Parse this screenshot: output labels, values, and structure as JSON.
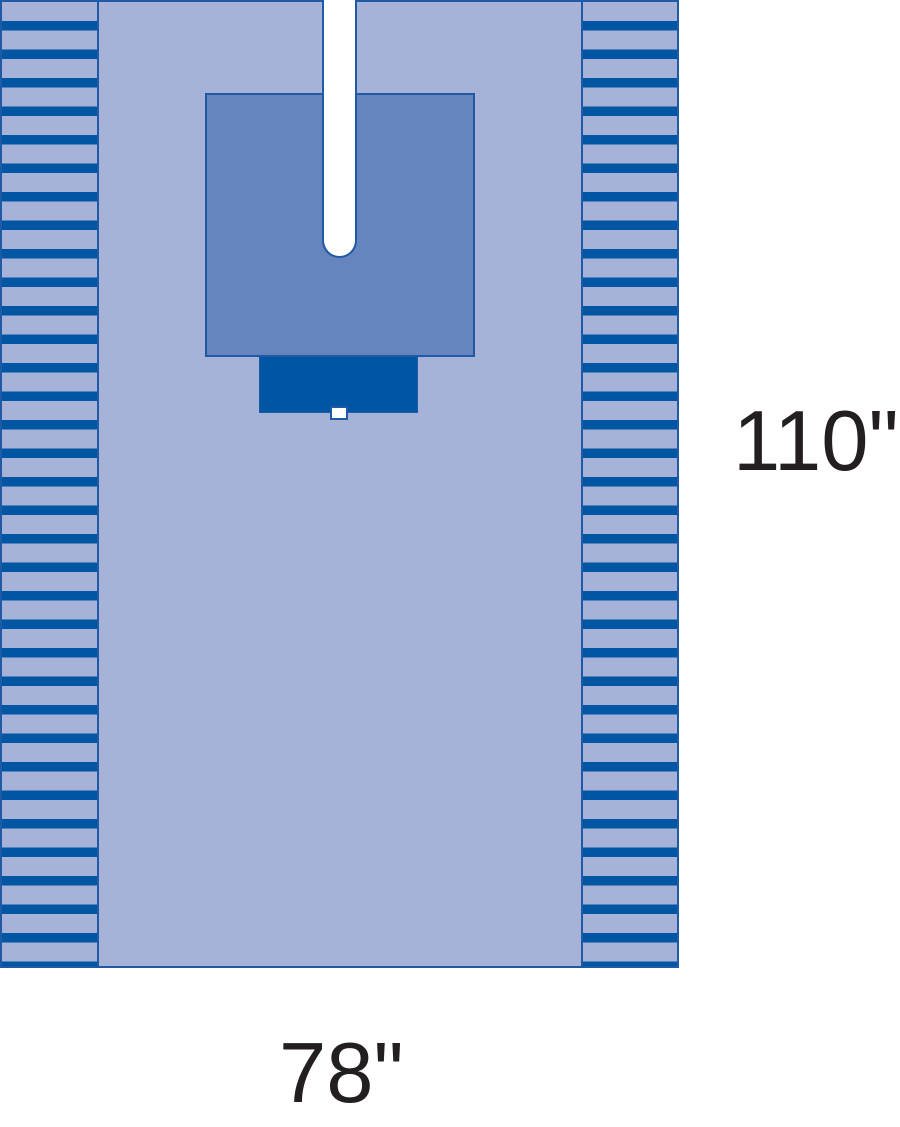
{
  "labels": {
    "height": "110\"",
    "width": "78\""
  },
  "colors": {
    "background": "#ffffff",
    "drape_light": "#a7b2d9",
    "panel_medium": "#6684bd",
    "accent_dark": "#0056a3",
    "outline": "#1f5aa6",
    "slot_white": "#ffffff",
    "label_text": "#231f20"
  }
}
